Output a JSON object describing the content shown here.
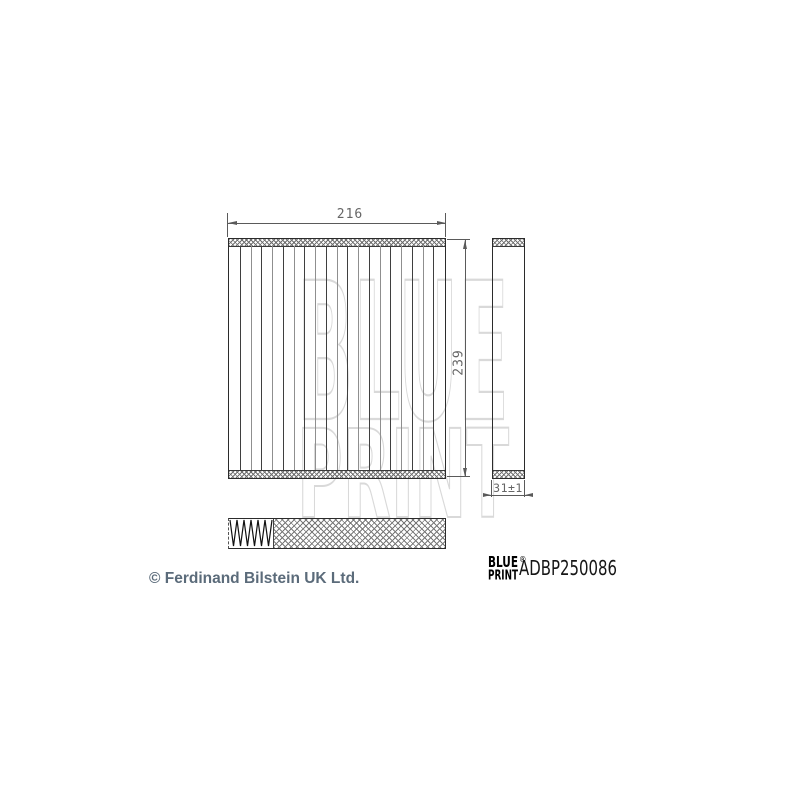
{
  "watermark": {
    "line1": "BLUE",
    "line2": "PRINT",
    "stroke_color": "#d9d9d9"
  },
  "drawing": {
    "front_view": {
      "width_label": "216",
      "height_label": "239",
      "pleat_count": 20
    },
    "side_view": {
      "depth_label": "31±1"
    },
    "line_color": "#2b2b2b",
    "dimension_color": "#5a5a5a",
    "dimension_text_color": "#666666"
  },
  "branding": {
    "logo_line1": "BLUE",
    "logo_line2": "PRINT",
    "registered_mark": "®",
    "part_number": "ADBP250086",
    "logo_color": "#000000"
  },
  "footer": {
    "copyright": "© Ferdinand Bilstein UK Ltd.",
    "color": "#5b6b7a"
  }
}
